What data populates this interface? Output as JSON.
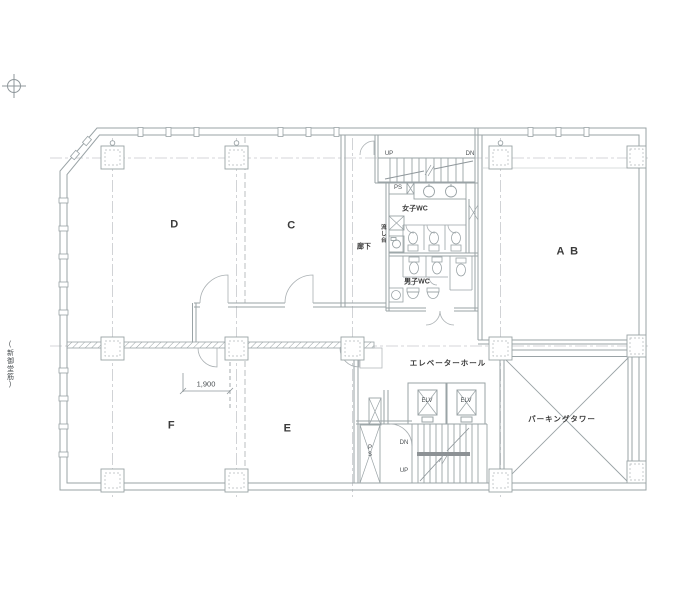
{
  "labels": {
    "street": "(新御堂筋)",
    "room_d": "D",
    "room_c": "C",
    "room_ab": "A B",
    "room_f": "F",
    "room_e": "E",
    "stair_top_up": "UP",
    "stair_top_dn": "DN",
    "ps_top": "PS",
    "wc_women": "女子WC",
    "sink_unit": "流し台",
    "corridor": "廊下",
    "wc_men": "男子WC",
    "elevator_hall": "エレベーターホール",
    "elv_left": "ELV",
    "elv_right": "ELV",
    "stair_bottom_dn": "DN",
    "stair_bottom_up": "UP",
    "ps_bottom": "PS",
    "parking_tower": "パーキングタワー",
    "dim_1900": "1,900"
  },
  "icons": {
    "top_left": "survey-crosshair-icon"
  },
  "colors": {
    "wall_line": "#9aa3a6",
    "grid_line": "#c6c9cc",
    "hatch": "#9aa3a6",
    "text": "#3b3b3b",
    "background": "#ffffff"
  }
}
